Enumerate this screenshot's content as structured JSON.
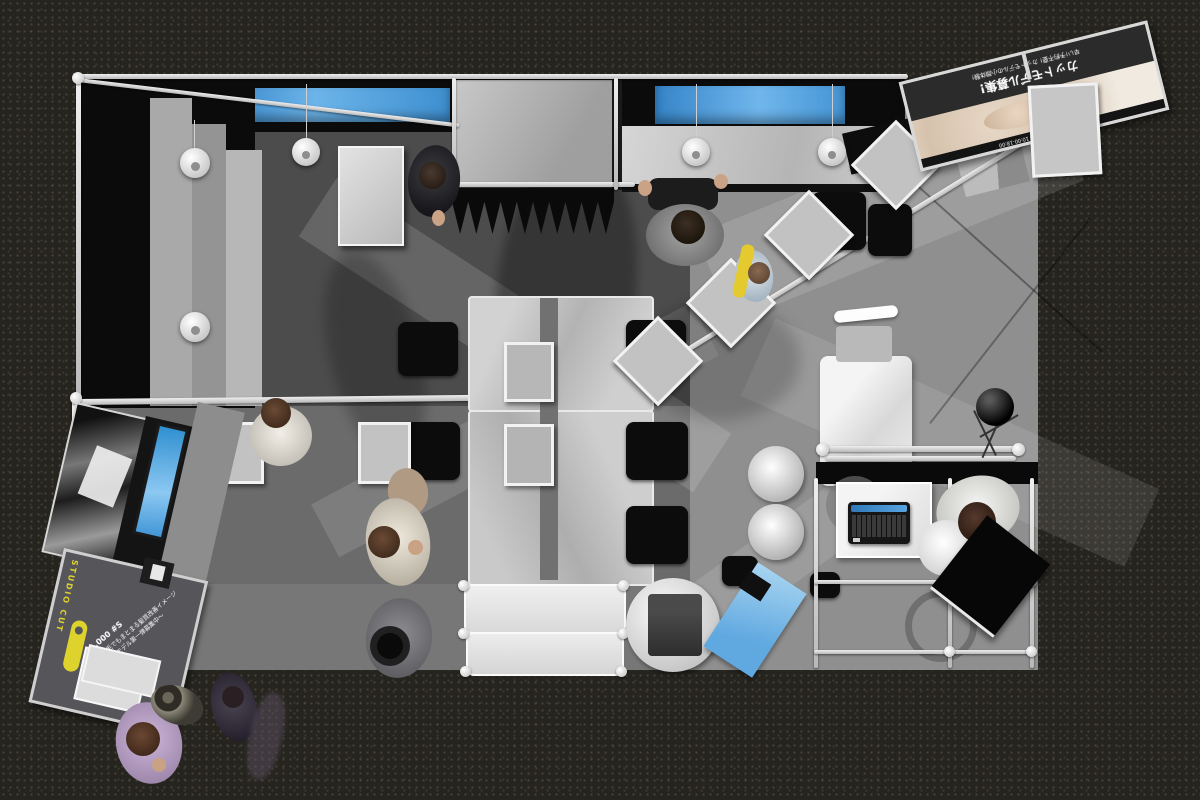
{
  "scene": {
    "title": "exhibition booth top view 3d render",
    "setting": "trade-show hall, dark speckled carpet aisle around a system-frame booth"
  },
  "colors": {
    "aisle_carpet": "#26241f",
    "booth_floor_dark": "#4c4c4c",
    "booth_floor_light": "#909090",
    "frame_silver": "#d8d8d8",
    "accent_blue": "#4da3e8",
    "accent_yellow": "#ddd32c",
    "wall_black": "#0b0b0b"
  },
  "banner": {
    "tagline_1": "早い!予約不要!",
    "tagline_2": "カットモデルの小顔体験!",
    "headline": "カットモデル募集!",
    "footer": "SATURDAY SALON OPEN 10:00-18:00"
  },
  "sign": {
    "brand_vertical": "STUDIO CUT",
    "price": "1,000 #S",
    "line_1": "くせ毛でもまとまる髪質改善イメージ",
    "line_2": "〜体験モデル第一弾募集中〜"
  },
  "objects": {
    "people_count": 9,
    "hanging_square_panels": 8,
    "pendant_lamps": 5,
    "monitors_blue": 3,
    "laptop": "open black laptop on white table",
    "tables": "two long center tables with black cube chairs"
  }
}
